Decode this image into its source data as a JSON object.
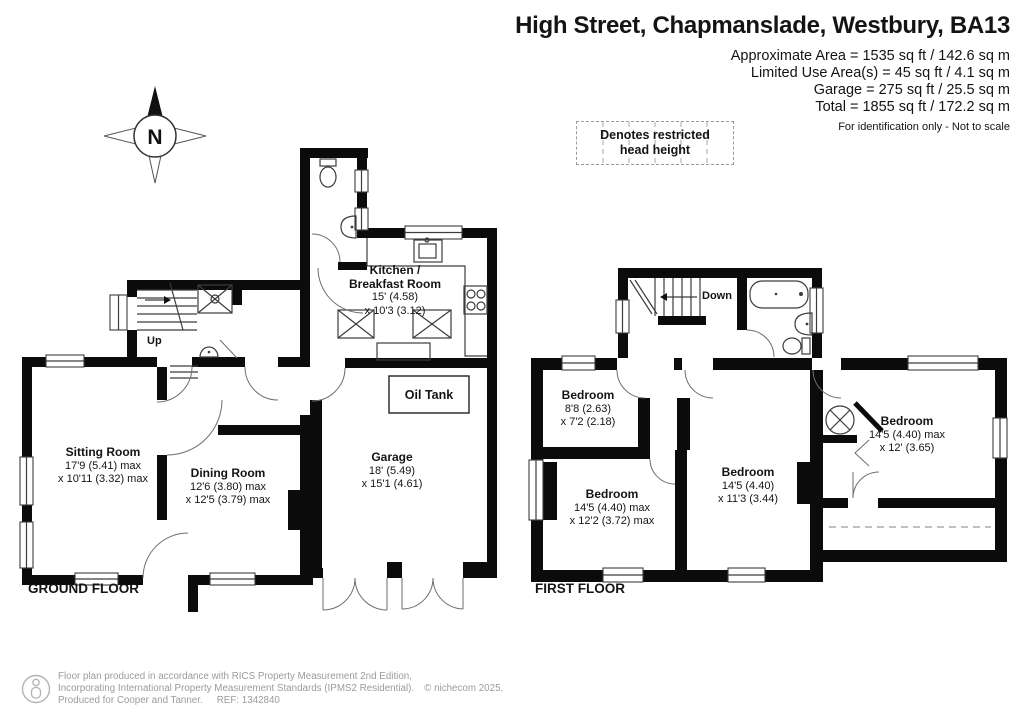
{
  "title": "High Street, Chapmanslade, Westbury, BA13",
  "area_summary": {
    "lines": [
      "Approximate Area = 1535 sq ft / 142.6 sq m",
      "Limited Use Area(s) = 45 sq ft / 4.1 sq m",
      "Garage = 275 sq ft / 25.5 sq m",
      "Total = 1855 sq ft / 172.2 sq m"
    ],
    "disclaimer": "For identification only - Not to scale"
  },
  "legend": {
    "restricted": "Denotes restricted head height"
  },
  "compass": {
    "label": "N"
  },
  "floors": {
    "ground": {
      "label": "GROUND FLOOR",
      "stairs_label": "Up",
      "rooms": {
        "sitting": {
          "name": "Sitting Room",
          "dims1": "17'9 (5.41) max",
          "dims2": "x 10'11 (3.32) max"
        },
        "dining": {
          "name": "Dining Room",
          "dims1": "12'6 (3.80) max",
          "dims2": "x 12'5 (3.79) max"
        },
        "kitchen": {
          "name": "Kitchen /",
          "name2": "Breakfast Room",
          "dims1": "15' (4.58)",
          "dims2": "x 10'3 (3.12)"
        },
        "garage": {
          "name": "Garage",
          "dims1": "18' (5.49)",
          "dims2": "x 15'1 (4.61)"
        },
        "oil_tank": {
          "name": "Oil Tank"
        }
      }
    },
    "first": {
      "label": "FIRST FLOOR",
      "stairs_label": "Down",
      "rooms": {
        "bedroom_small": {
          "name": "Bedroom",
          "dims1": "8'8 (2.63)",
          "dims2": "x 7'2 (2.18)"
        },
        "bedroom_left": {
          "name": "Bedroom",
          "dims1": "14'5 (4.40) max",
          "dims2": "x 12'2 (3.72) max"
        },
        "bedroom_middle": {
          "name": "Bedroom",
          "dims1": "14'5 (4.40)",
          "dims2": "x 11'3 (3.44)"
        },
        "bedroom_right": {
          "name": "Bedroom",
          "dims1": "14'5 (4.40) max",
          "dims2": "x 12' (3.65)"
        }
      }
    }
  },
  "footer": {
    "line1": "Floor plan produced in accordance with RICS Property Measurement 2nd Edition,",
    "line2": "Incorporating International Property Measurement Standards (IPMS2 Residential).",
    "copyright": "© nichecom 2025.",
    "line3": "Produced for Cooper and Tanner.",
    "ref": "REF: 1342840"
  }
}
